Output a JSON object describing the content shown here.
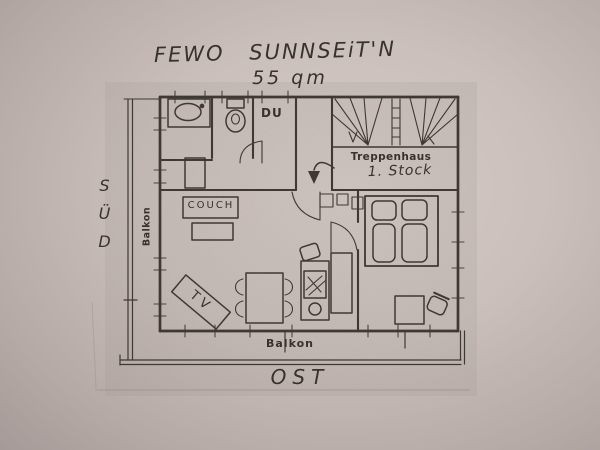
{
  "photo": {
    "title": "FEWO SUNNSEiT'N",
    "area": "55 qm"
  },
  "orientation": {
    "south": "SÜD",
    "east": "OST"
  },
  "labels": {
    "stairwell": "Treppenhaus",
    "stairwell_floor": "1. Stock",
    "shower": "DU",
    "couch": "COUCH",
    "tv": "TV",
    "balcony_left": "Balkon",
    "balcony_bottom": "Balkon"
  },
  "colors": {
    "paper": "#cabfbb",
    "ink": "#3f3833"
  }
}
